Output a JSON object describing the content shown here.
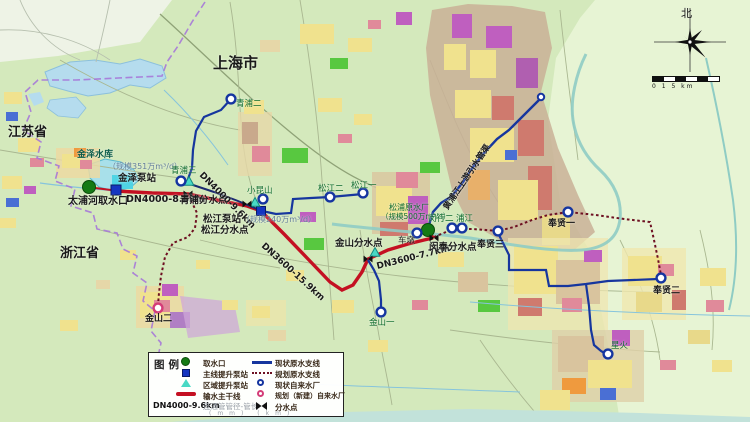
{
  "labels": {
    "shanghai": "上海市",
    "jiangsu": "江苏省",
    "zhejiang": "浙江省",
    "jinze_reservoir": "金泽水库",
    "jinze_pump_scale": "（规模351万m³/d）",
    "jinze_pump": "金泽泵站",
    "taipu_intake": "太浦河取水口",
    "dn4000_86": "DN4000-8.6km",
    "qingpu_split": "青浦分水点",
    "qingpu3": "青浦三",
    "qingpu2": "青浦二",
    "dn4000_96": "DN4000-9.6km",
    "xiaokunshan": "小昆山",
    "songjiang_pump": "松江泵站",
    "songjiang_pump_scale": "（规模240万m³/d）",
    "songjiang_split": "松江分水点",
    "songjiang2": "松江二",
    "songjiang1": "松江一",
    "dn3600_159": "DN3600-15.9km",
    "jinshan_split": "金山分水点",
    "dn3600_77": "DN3600-7.7km",
    "chedun": "车墩",
    "songpu_plant": "松浦原水厂",
    "songpu_scale": "（规模500万m³/d）",
    "minfeng_split": "闵奉分水点",
    "minhang2": "闵行二",
    "pujiang": "浦江",
    "fengxian3": "奉贤三",
    "fengxian1": "奉贤一",
    "fengxian2": "奉贤二",
    "jinshan2": "金山二",
    "jinshan1": "金山一",
    "xinghuo": "星火",
    "huangpu_conduit": "黄浦江上游引水管渠"
  },
  "legend": {
    "title": "图例",
    "left": [
      "取水口",
      "主线提升泵站",
      "区域提升泵站",
      "输水主干线"
    ],
    "dn_example": "DN4000-9.6km",
    "dn_desc": "连通管管径-管长",
    "dn_units": "(mm)  (km)",
    "right": [
      "现状原水支线",
      "规划原水支线",
      "现状自来水厂",
      "规划（新建）自来水厂",
      "分水点"
    ]
  },
  "compass": {
    "north": "北"
  },
  "scale_bar": {
    "text": "0 1   5        km"
  },
  "colors": {
    "main_line": "#c41022",
    "branch_line": "#16369e",
    "planned_line": "#6e1022",
    "boundary": "#a678d8",
    "intake": "#157a15",
    "pump_station": "#1535c0",
    "regional_pump": "#49d9c5",
    "existing_plant_ring": "#1535a0",
    "planned_plant_ring": "#d43d78",
    "land": "#d4e9bc",
    "water": "#b5dcee"
  }
}
